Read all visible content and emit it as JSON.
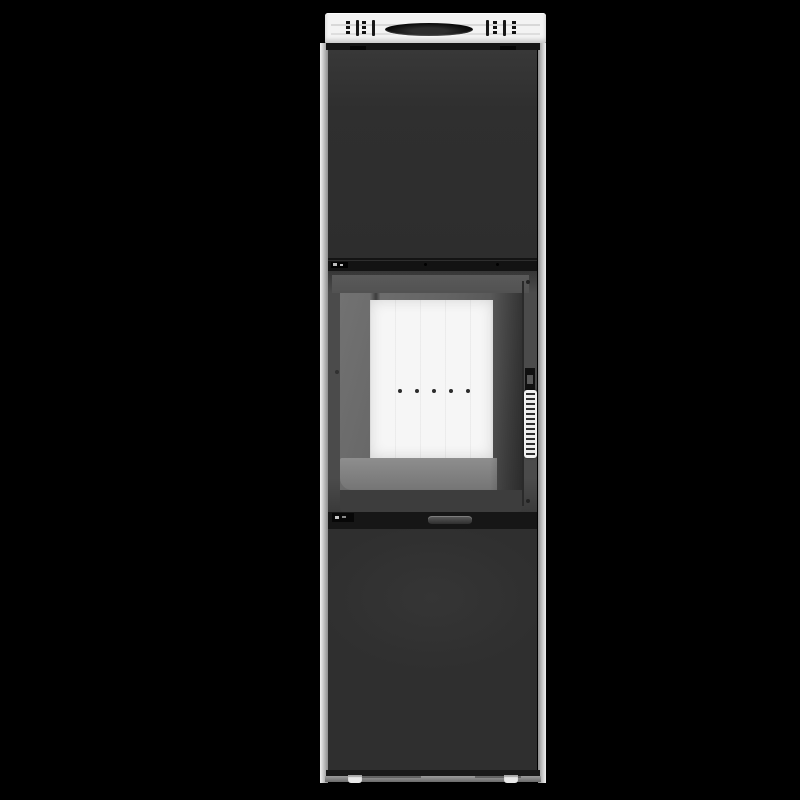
{
  "meta": {
    "type": "product-photo",
    "subject": "Freestanding wood-burning stove, front view",
    "background_color": "#000000"
  },
  "colors": {
    "bg": "#000000",
    "plate": "#f3f3f3",
    "stripe": "#d8d8d8",
    "oval": "#070707",
    "panel": "#2f2f2f",
    "seam": "#141414",
    "door": "#4b4b4b",
    "glass": "#646464",
    "firebox": "#f6f6f6",
    "floorstrip": "#757575",
    "hole": "#2c2c2c",
    "handle": "#f2f2f2",
    "rib": "#2f2f2f",
    "rail": "#c6c6c6",
    "base": "#6b6b6b",
    "foot": "#e8e8e8"
  },
  "features": {
    "top_plate": {
      "flue_opening": "oval",
      "vent_grilles": {
        "count": 2,
        "columns_per_grille": 2,
        "holes_per_column": 3
      },
      "stripes": 2
    },
    "door": {
      "air_holes": {
        "count": 5
      },
      "handle": {
        "style": "ribbed-vertical-grip"
      }
    },
    "base": {
      "feet": {
        "count": 2
      }
    }
  }
}
